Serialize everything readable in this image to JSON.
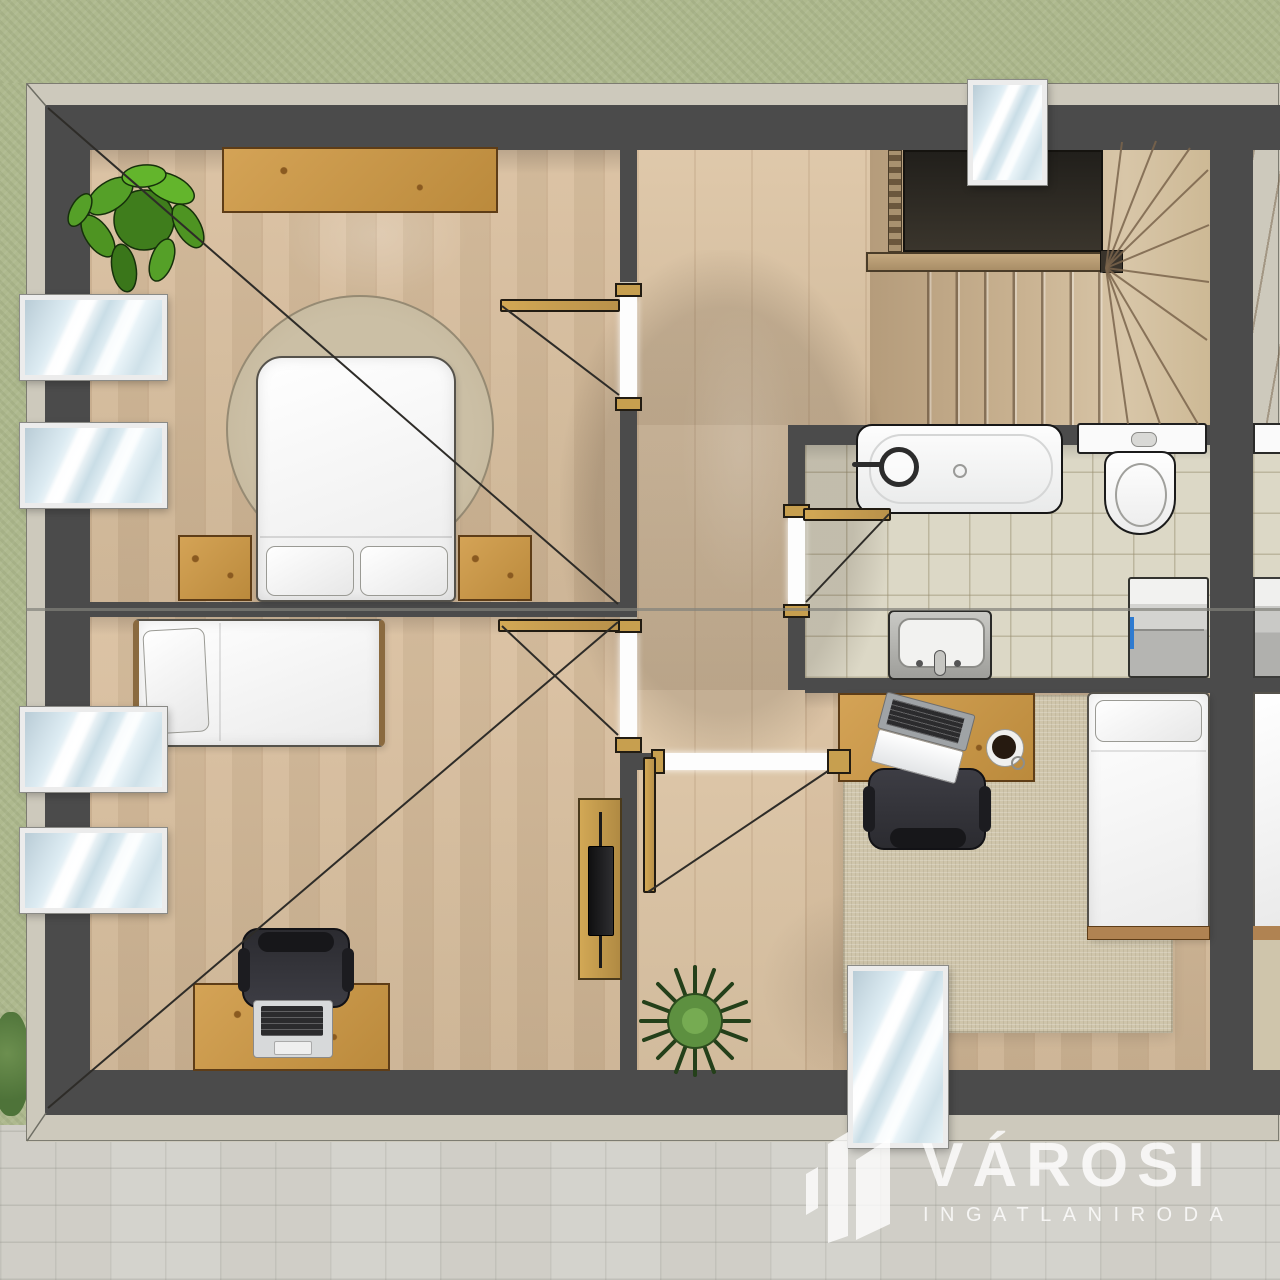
{
  "watermark": {
    "brand": "VÁROSI",
    "tagline": "INGATLANIRODA",
    "text_color": "#ffffff",
    "logo": "buildings-logo-icon"
  },
  "palette": {
    "grass": "#aeb98e",
    "pavement": "#d4d3cd",
    "wall": "#4b4b4b",
    "wood_floor": "#d8bd9b",
    "hall_floor": "#ddc5a5",
    "stair_wood": "#c9b291",
    "bathroom_tile": "#dcd8c6",
    "rug": "#cfc5ab",
    "door_wood": "#c79f4f",
    "window_glass": "#d6e6ee",
    "roofline": "#6e6e64"
  },
  "plan": {
    "type": "attic-floor-plan-render",
    "rooms": [
      {
        "id": "bedroom-top-left",
        "items": [
          "double-bed",
          "pillow",
          "pillow",
          "nightstand",
          "nightstand",
          "wall-shelf",
          "potted-plant",
          "round-rug",
          "roof-window",
          "roof-window",
          "door",
          "slope-diagonal-line"
        ]
      },
      {
        "id": "bedroom-bottom-left",
        "items": [
          "single-bed",
          "pillow",
          "desk",
          "laptop",
          "office-chair",
          "tv-console",
          "tv",
          "roof-window",
          "roof-window",
          "door",
          "slope-diagonal-line"
        ]
      },
      {
        "id": "hallway",
        "items": [
          "spiky-plant",
          "door-to-bedroom-right"
        ]
      },
      {
        "id": "staircase",
        "items": [
          "stairwell-void",
          "railing",
          "straight-treads",
          "winder-treads",
          "roof-window"
        ]
      },
      {
        "id": "bathroom",
        "items": [
          "bathtub",
          "bathtub-faucet",
          "toilet",
          "sink-vanity",
          "washing-machine",
          "door"
        ]
      },
      {
        "id": "bedroom-bottom-right",
        "items": [
          "single-bed",
          "pillow",
          "desk",
          "laptop",
          "coffee-cup",
          "office-chair",
          "area-rug",
          "roof-window"
        ]
      },
      {
        "id": "mirrored-neighbour-unit-strip",
        "items": [
          "staircase",
          "bathroom-tile",
          "toilet-tank",
          "washing-machine",
          "single-bed",
          "area-rug"
        ]
      }
    ]
  }
}
